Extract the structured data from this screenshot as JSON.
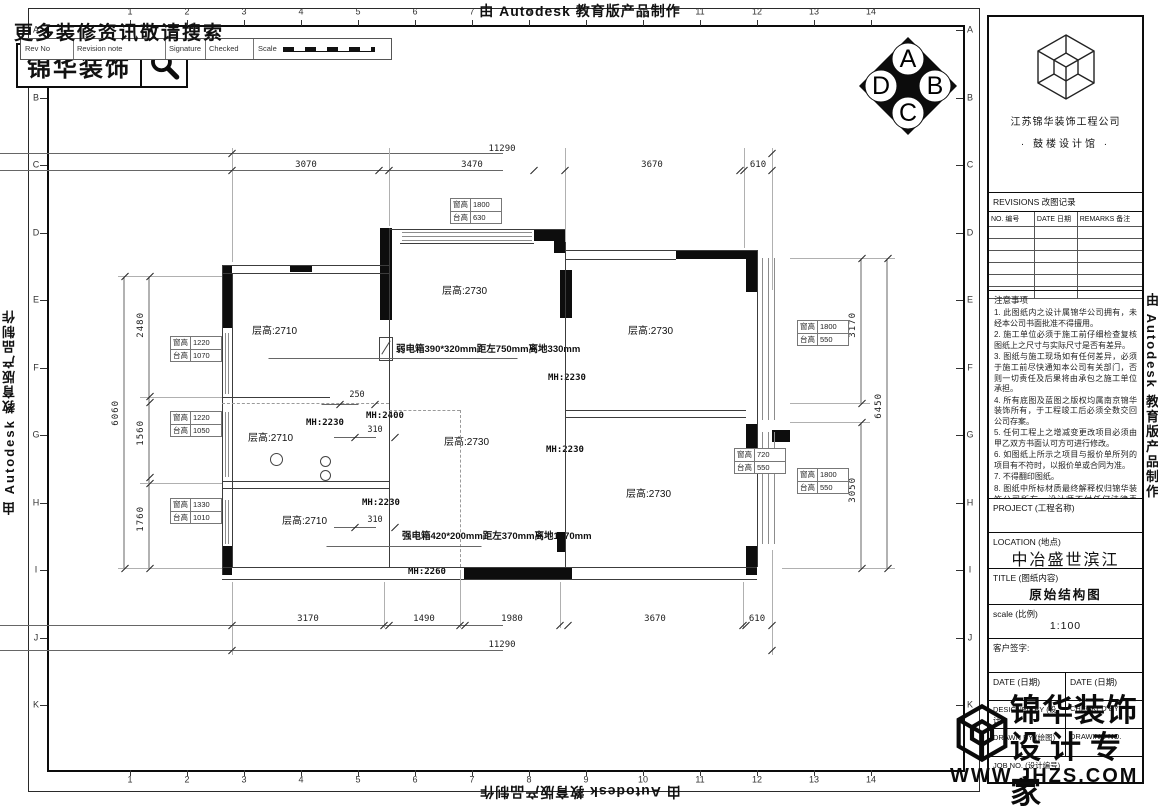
{
  "autodesk_credit": "由 Autodesk 教育版产品制作",
  "promo": {
    "search_text": "更多装修资讯敬请搜索",
    "brand": "锦华装饰"
  },
  "rev_strip": {
    "rev_no": "Rev No",
    "revision_note": "Revision note",
    "signature": "Signature",
    "checked": "Checked",
    "scale": "Scale"
  },
  "compass": {
    "top": "A",
    "right": "B",
    "bottom": "C",
    "left": "D"
  },
  "grid": {
    "cols": [
      "1",
      "2",
      "3",
      "4",
      "5",
      "6",
      "7",
      "8",
      "9",
      "10",
      "11",
      "12",
      "13",
      "14"
    ],
    "rows": [
      "A",
      "B",
      "C",
      "D",
      "E",
      "F",
      "G",
      "H",
      "I",
      "J",
      "K"
    ]
  },
  "plan": {
    "rooms": [
      "层高:2710",
      "层高:2730",
      "层高:2730",
      "层高:2710",
      "层高:2730",
      "层高:2730",
      "层高:2710"
    ],
    "mh": [
      "MH:2230",
      "MH:2400",
      "MH:2230",
      "MH:2230",
      "MH:2230",
      "MH:2260"
    ],
    "weak_box": "弱电箱390*320mm距左750mm离地330mm",
    "strong_box": "强电箱420*200mm距左370mm离地1670mm",
    "win_label": "窗高",
    "sill_label": "台高",
    "window_tags": [
      {
        "win": "1800",
        "sill": "630"
      },
      {
        "win": "1220",
        "sill": "1070"
      },
      {
        "win": "1220",
        "sill": "1050"
      },
      {
        "win": "1330",
        "sill": "1010"
      },
      {
        "win": "1800",
        "sill": "550"
      },
      {
        "win": "720",
        "sill": "550"
      },
      {
        "win": "1800",
        "sill": "550"
      }
    ],
    "dims": {
      "top_total": "11290",
      "top_segs": [
        "3070",
        "3470",
        "3670",
        "610"
      ],
      "bottom_segs": [
        "3170",
        "1490",
        "1980",
        "3670",
        "610"
      ],
      "bottom_total": "11290",
      "left_total": "6060",
      "left_segs": [
        "2480",
        "1560",
        "1760"
      ],
      "right_segs": [
        "3170",
        "3050"
      ],
      "right_total": "6450",
      "d250": "250",
      "d310a": "310",
      "d310b": "310"
    }
  },
  "titleblock": {
    "company": "江苏锦华装饰工程公司",
    "branch": "·   鼓楼设计馆   ·",
    "revisions_title": "REVISIONS 改图记录",
    "rev_col_no": "NO. 编号",
    "rev_col_date": "DATE 日期",
    "rev_col_remarks": "REMARKS 备注",
    "notes_title": "注意事项",
    "notes": [
      "1. 此图纸内之设计属锦华公司拥有，未经本公司书面批准不得擅用。",
      "2. 施工单位必须于施工前仔细检查复核图纸上之尺寸与实际尺寸是否有差异。",
      "3. 图纸与施工现场如有任何差异，必须于施工前尽快通知本公司有关部门，否则一切责任及后果将由承包之施工单位承担。",
      "4. 所有底图及蓝图之版权均属南京锦华装饰所有，于工程竣工后必须全数交回公司存案。",
      "5. 任何工程上之增减变更改项目必须由甲乙双方书面认可方可进行修改。",
      "6. 如图纸上所示之项目与报价单所列的项目有不符时，以报价单或合同为准。",
      "7. 不得翻印图纸。",
      "8. 图纸中所标材质最终解释权归锦华装饰公司所有，设计师不付任何法律责任。"
    ],
    "project_label": "PROJECT (工程名称)",
    "location_label": "LOCATION (地点)",
    "location_value": "中冶盛世滨江",
    "title_label": "TITLE (图纸内容)",
    "title_value": "原始结构图",
    "scale_label": "scale  (比例)",
    "scale_value": "1:100",
    "sign_label": "客户签字:",
    "date_label": "DATE (日期)",
    "designed_label": "DESIGNED BY (设计)",
    "checked_label": "CHECKED BY",
    "drawn_label": "DRAWN BY (绘图)",
    "drawingno_label": "DRAWING NO.",
    "jobno_label": "JOB NO. (设计编号)"
  },
  "footer_logo": {
    "brand": "锦华装饰",
    "tagline": "设计专家",
    "url": "WWW.JHZS.COM"
  }
}
